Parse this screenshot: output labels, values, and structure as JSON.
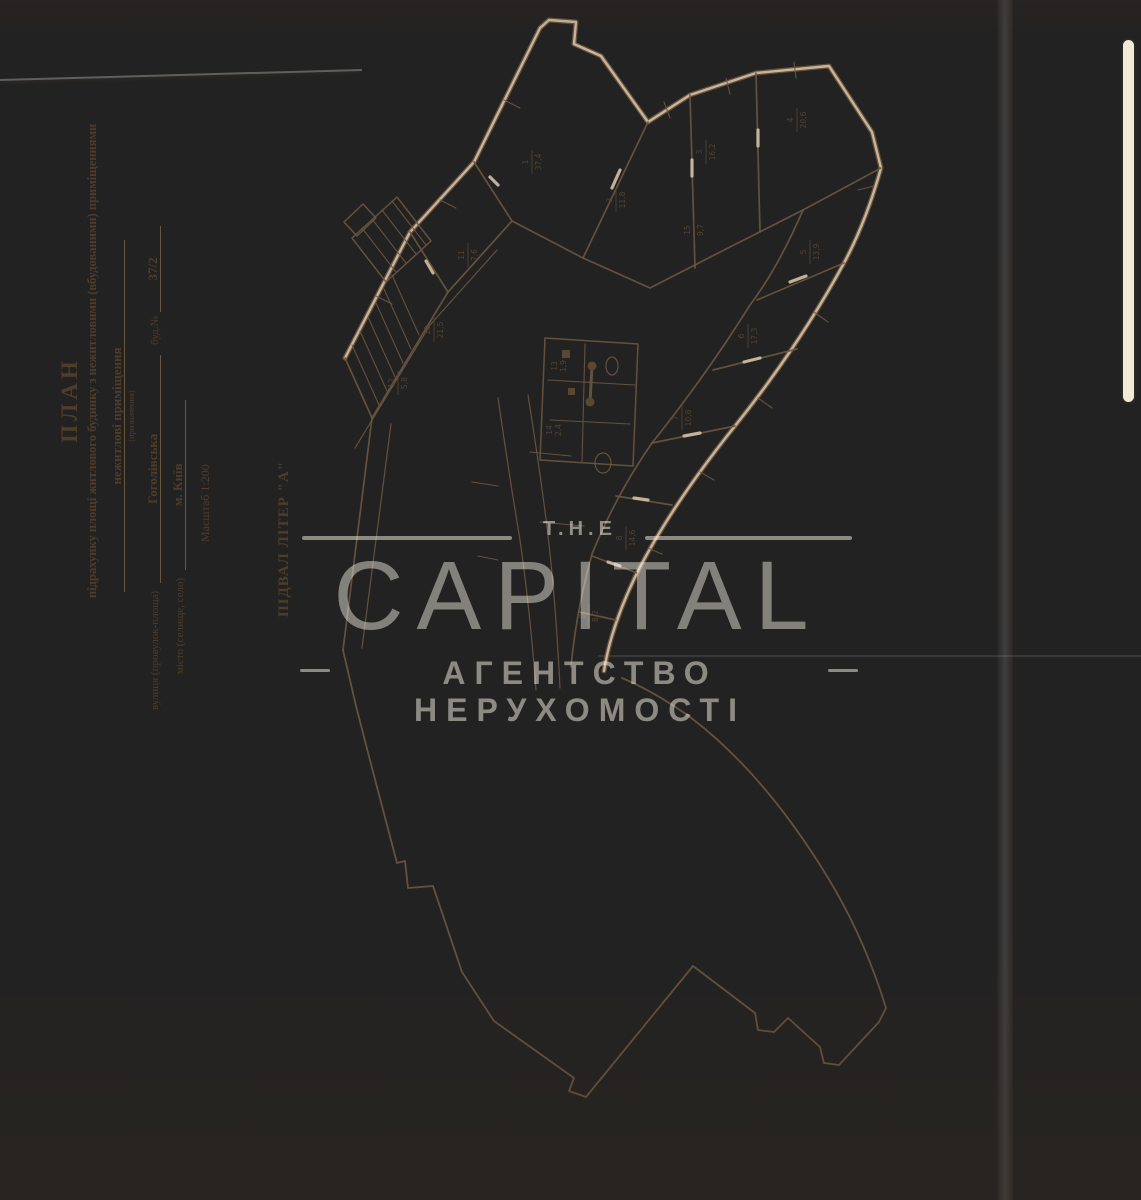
{
  "document": {
    "title": "ПЛАН",
    "subtitle": "підрахунку площі житлового будинку з нежитловими (вбудованими) приміщеннями",
    "purpose_value": "нежитлові приміщення",
    "purpose_caption": "(призначення)",
    "street_label": "вулиця (провулок-площа)",
    "street_value": "Гоголівська",
    "building_label": "буд.№",
    "building_value": "37/2",
    "city_label": "місто (селище, село)",
    "city_value": "м. Київ",
    "scale_label": "Масштаб 1:200",
    "basement_label": "ПІДВАЛ ЛІТЕР \"А\""
  },
  "watermark": {
    "the": "T.H.E",
    "brand": "CAPITAL",
    "tagline": "АГЕНТСТВО НЕРУХОМОСТІ"
  },
  "plan": {
    "rooms": [
      {
        "num": "1",
        "area": "37,4"
      },
      {
        "num": "2",
        "area": "11,8"
      },
      {
        "num": "3",
        "area": "16,2"
      },
      {
        "num": "4",
        "area": "20,6"
      },
      {
        "num": "5",
        "area": "13,9"
      },
      {
        "num": "6",
        "area": "17,3"
      },
      {
        "num": "7",
        "area": "10,8"
      },
      {
        "num": "8",
        "area": "14,6"
      },
      {
        "num": "9",
        "area": "8,2"
      },
      {
        "num": "10",
        "area": "21,5"
      },
      {
        "num": "11",
        "area": "7,6"
      },
      {
        "num": "12",
        "area": "5,8"
      },
      {
        "num": "13",
        "area": "1,9"
      },
      {
        "num": "14",
        "area": "2,4"
      },
      {
        "num": "15",
        "area": "9,7"
      }
    ]
  },
  "colors": {
    "paper": "#d3c0a3",
    "ink": "#6b5740",
    "text": "#4f3d29",
    "watermark": "#f7f1e5"
  }
}
